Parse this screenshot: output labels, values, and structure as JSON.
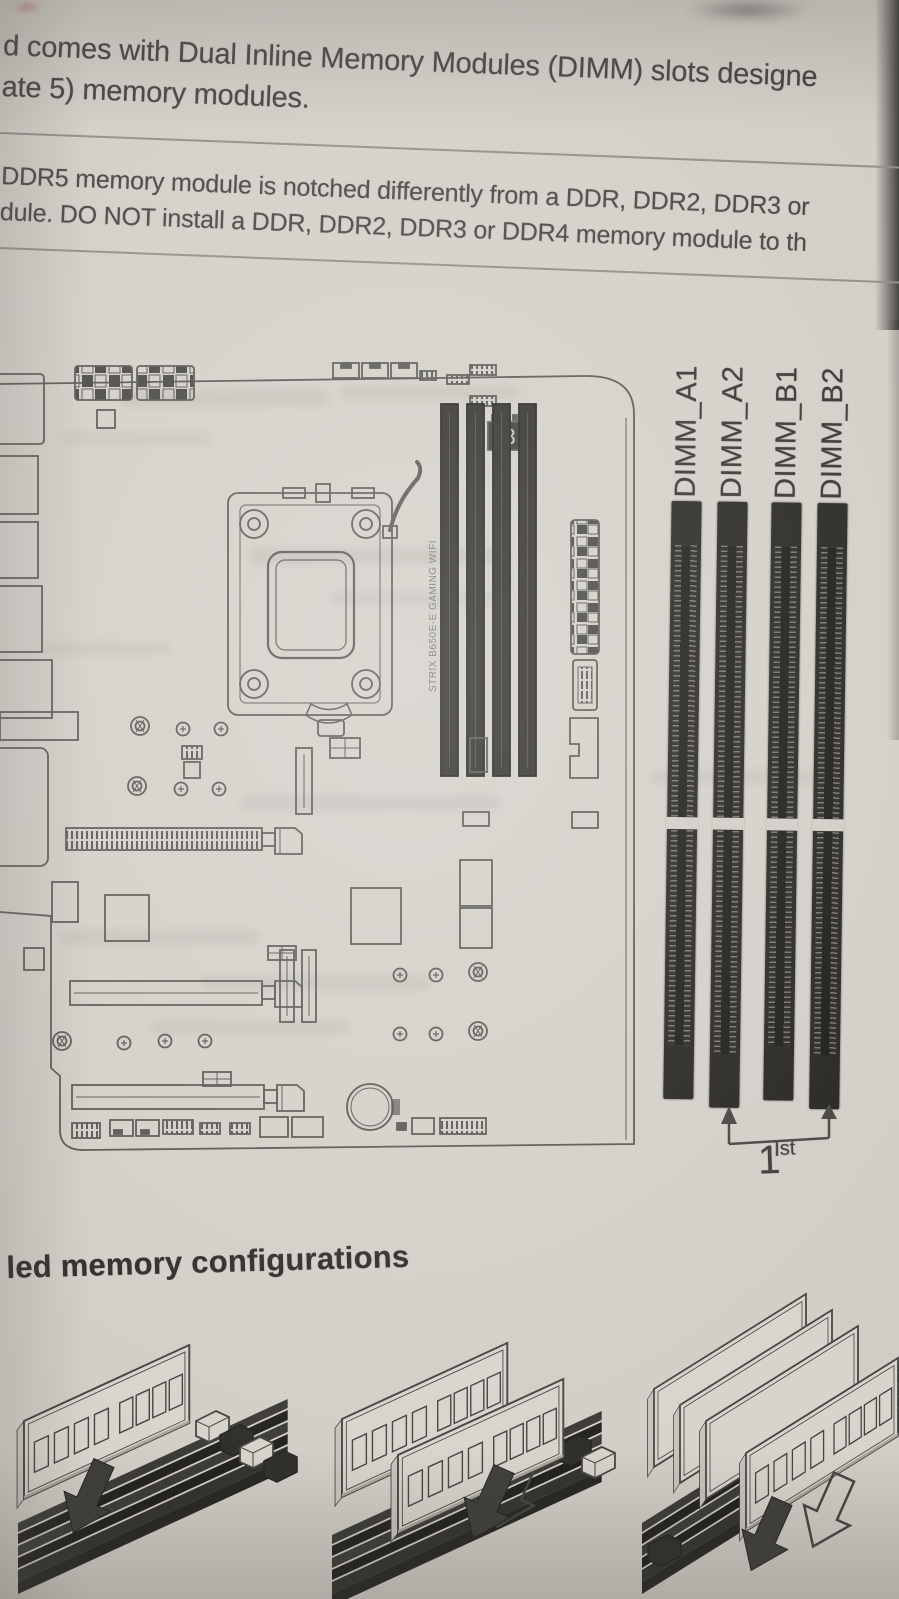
{
  "page": {
    "intro": {
      "line1": "d comes with Dual Inline Memory Modules (DIMM) slots designe",
      "line2": "ate 5) memory modules."
    },
    "note": {
      "line1": "DDR5 memory module is notched differently from a DDR, DDR2, DDR3 or",
      "line2": "dule. DO NOT install a DDR, DDR2, DDR3 or DDR4 memory module to th"
    },
    "section_heading": "led memory configurations"
  },
  "diagram": {
    "dimm_labels": [
      "DIMM_A1",
      "DIMM_A2",
      "DIMM_B1",
      "DIMM_B2"
    ],
    "board_vertical_text": "STRIX B650E-E GAMING WIFI",
    "debug_display": "88",
    "priority": {
      "number": "1",
      "suffix": "st"
    }
  },
  "colors": {
    "paper": "#d2cec7",
    "ink": "#3a3936",
    "line_art": "#56554f",
    "slot_dark": "#24231f",
    "page_edge": "#35342f"
  }
}
